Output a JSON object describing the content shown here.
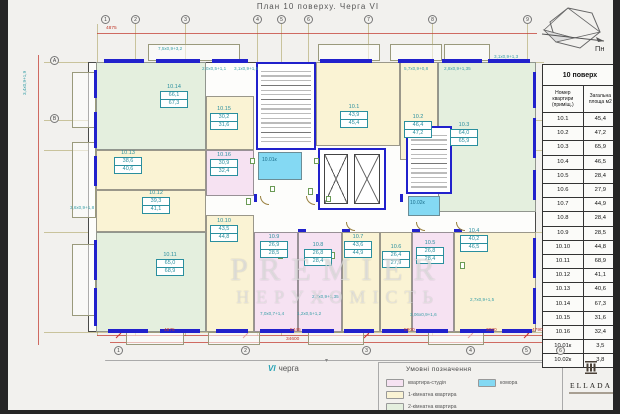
{
  "title": "План 10 поверху. Черга VI",
  "compass_label": "Пн",
  "table": {
    "title": "10 поверх",
    "col_apartment": "Номер квартири (приміщ.)",
    "col_area": "Загальна площа м2",
    "rows": [
      {
        "id": "10.1",
        "area": "45,4"
      },
      {
        "id": "10.2",
        "area": "47,2"
      },
      {
        "id": "10.3",
        "area": "65,9"
      },
      {
        "id": "10.4",
        "area": "46,5"
      },
      {
        "id": "10.5",
        "area": "28,4"
      },
      {
        "id": "10.6",
        "area": "27,9"
      },
      {
        "id": "10.7",
        "area": "44,9"
      },
      {
        "id": "10.8",
        "area": "28,4"
      },
      {
        "id": "10.9",
        "area": "28,5"
      },
      {
        "id": "10.10",
        "area": "44,8"
      },
      {
        "id": "10.11",
        "area": "68,9"
      },
      {
        "id": "10.12",
        "area": "41,1"
      },
      {
        "id": "10.13",
        "area": "40,6"
      },
      {
        "id": "10.14",
        "area": "67,3"
      },
      {
        "id": "10.15",
        "area": "31,6"
      },
      {
        "id": "10.16",
        "area": "32,4"
      },
      {
        "id": "10.01к",
        "area": "3,5"
      },
      {
        "id": "10.02к",
        "area": "3,8"
      }
    ]
  },
  "legend": {
    "title": "Умовні позначення",
    "items": [
      {
        "label": "квартира-студія",
        "color": "#f6e2f2"
      },
      {
        "label": "1-кімнатна квартира",
        "color": "#faf3d4"
      },
      {
        "label": "2-кімнатна квартира",
        "color": "#e4efde"
      },
      {
        "label": "комора",
        "color": "#84d9f3"
      }
    ]
  },
  "phase": {
    "roman": "VI",
    "word": "черга"
  },
  "logo": {
    "name": "ELLADA"
  },
  "watermark": {
    "line1": "PREMIER",
    "line2": "НЕРУХОМІСТЬ"
  },
  "plan": {
    "rooms": {
      "r1": {
        "id": "10.1",
        "living": "43,9",
        "total": "45,4"
      },
      "r2": {
        "id": "10.2",
        "living": "46,4",
        "total": "47,2"
      },
      "r3": {
        "id": "10.3",
        "living": "64,0",
        "total": "65,9"
      },
      "r4": {
        "id": "10.4",
        "living": "40,2",
        "total": "46,5"
      },
      "r5": {
        "id": "10.5",
        "living": "26,8",
        "total": "28,4"
      },
      "r6": {
        "id": "10.6",
        "living": "26,4",
        "total": "27,9"
      },
      "r7": {
        "id": "10.7",
        "living": "43,6",
        "total": "44,9"
      },
      "r8": {
        "id": "10.8",
        "living": "26,8",
        "total": "28,4"
      },
      "r9": {
        "id": "10.9",
        "living": "26,9",
        "total": "28,5"
      },
      "r10": {
        "id": "10.10",
        "living": "43,5",
        "total": "44,8"
      },
      "r11": {
        "id": "10.11",
        "living": "65,0",
        "total": "68,9"
      },
      "r12": {
        "id": "10.12",
        "living": "39,3",
        "total": "41,1"
      },
      "r13": {
        "id": "10.13",
        "living": "38,6",
        "total": "40,6"
      },
      "r14": {
        "id": "10.14",
        "living": "66,1",
        "total": "67,3"
      },
      "r15": {
        "id": "10.15",
        "living": "30,2",
        "total": "31,6"
      },
      "r16": {
        "id": "10.16",
        "living": "30,9",
        "total": "32,4"
      }
    },
    "storages": {
      "s1": "10.01к",
      "s2": "10.02к"
    },
    "axes": {
      "top": [
        "1",
        "2",
        "3",
        "4",
        "5",
        "6",
        "7",
        "8",
        "9"
      ],
      "left": [
        "А",
        "В"
      ],
      "bottom": [
        "1",
        "2",
        "3",
        "4",
        "5",
        "6"
      ]
    },
    "dims": {
      "top": "4875",
      "bottom": [
        "4875",
        "5445",
        "5900",
        "3080",
        "4790"
      ],
      "total": "34600",
      "balcony": [
        "7,5х0,9+3,2",
        "2,0х0,5+1,1",
        "3,1х0,9+1,5",
        "5,7х0,9+0,8",
        "2,8х0,9+1,35",
        "3,1х0,9+1,3",
        "3,6х0,9+1,8",
        "3,4х0,9+1,9",
        "7,0х0,7+1,4",
        "1,2х0,5+1,2",
        "2,7х0,9+1,35",
        "2,7х0,9+1,5",
        "3,06х0,9+1,6"
      ]
    }
  }
}
